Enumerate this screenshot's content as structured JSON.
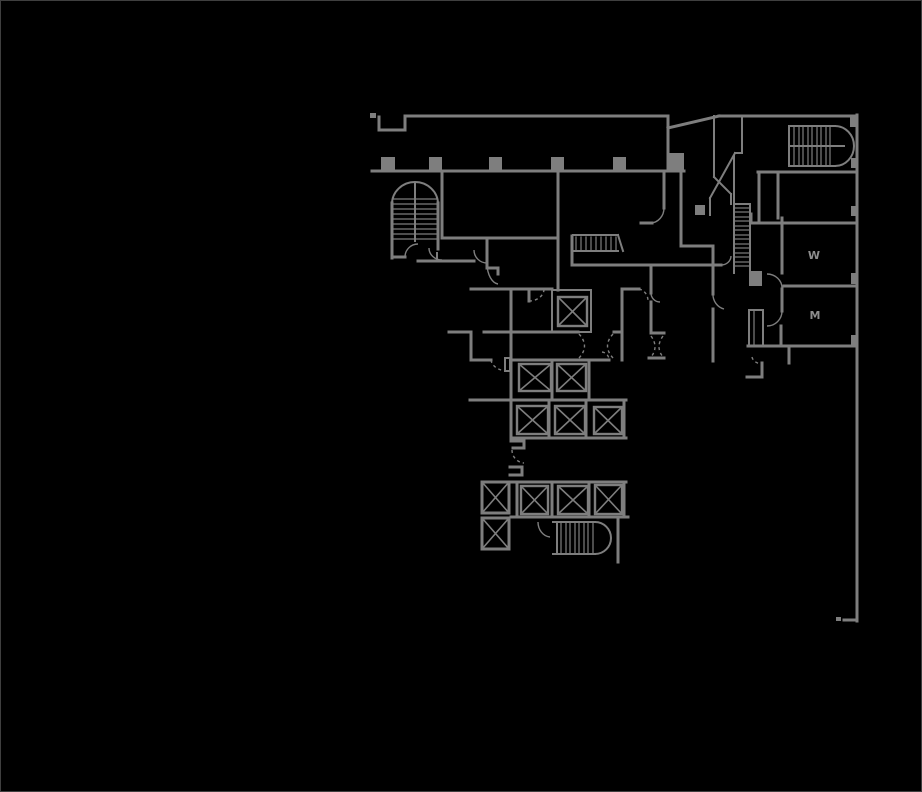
{
  "app": {
    "type": "floor-plan-viewer",
    "background": "#000000",
    "border_color": "#3f3f3f"
  },
  "plan": {
    "line_color": "#7e7e7e",
    "label_color": "#8d8d8d",
    "labels": [
      {
        "text": "W",
        "x": 813,
        "y": 258
      },
      {
        "text": "M",
        "x": 814,
        "y": 318
      }
    ],
    "walls": [
      [
        378,
        116,
        378,
        129
      ],
      [
        378,
        129,
        404,
        129
      ],
      [
        404,
        129,
        404,
        115
      ],
      [
        404,
        115,
        667,
        115
      ],
      [
        667,
        115,
        667,
        170
      ],
      [
        667,
        127,
        718,
        115
      ],
      [
        718,
        115,
        856,
        115
      ],
      [
        856,
        114,
        856,
        620
      ],
      [
        856,
        619,
        843,
        619
      ],
      [
        371,
        170,
        683,
        170
      ],
      [
        391,
        202,
        391,
        257
      ],
      [
        437,
        202,
        437,
        248
      ],
      [
        391,
        256,
        404,
        256
      ],
      [
        417,
        260,
        473,
        260
      ],
      [
        441,
        170,
        441,
        237
      ],
      [
        441,
        237,
        557,
        237
      ],
      [
        557,
        170,
        557,
        289
      ],
      [
        486,
        237,
        486,
        267
      ],
      [
        486,
        267,
        497,
        267
      ],
      [
        497,
        267,
        497,
        273
      ],
      [
        470,
        288,
        551,
        288
      ],
      [
        528,
        288,
        528,
        300
      ],
      [
        448,
        331,
        470,
        331
      ],
      [
        470,
        331,
        470,
        359
      ],
      [
        470,
        359,
        490,
        359
      ],
      [
        483,
        331,
        577,
        331
      ],
      [
        613,
        331,
        621,
        331
      ],
      [
        510,
        288,
        510,
        439
      ],
      [
        510,
        359,
        608,
        359
      ],
      [
        621,
        288,
        621,
        359
      ],
      [
        588,
        359,
        588,
        399
      ],
      [
        551,
        359,
        551,
        399
      ],
      [
        469,
        399,
        625,
        399
      ],
      [
        548,
        399,
        548,
        437
      ],
      [
        585,
        399,
        585,
        437
      ],
      [
        623,
        399,
        623,
        437
      ],
      [
        510,
        437,
        625,
        437
      ],
      [
        510,
        440,
        523,
        440
      ],
      [
        523,
        440,
        523,
        447
      ],
      [
        523,
        447,
        512,
        447
      ],
      [
        509,
        466,
        521,
        466
      ],
      [
        521,
        466,
        521,
        474
      ],
      [
        509,
        474,
        521,
        474
      ],
      [
        507,
        481,
        625,
        481
      ],
      [
        516,
        481,
        516,
        516
      ],
      [
        551,
        481,
        551,
        516
      ],
      [
        588,
        481,
        588,
        516
      ],
      [
        623,
        481,
        623,
        516
      ],
      [
        510,
        516,
        627,
        516
      ],
      [
        617,
        516,
        617,
        561
      ],
      [
        571,
        235,
        571,
        264
      ],
      [
        571,
        264,
        720,
        264
      ],
      [
        650,
        264,
        650,
        292
      ],
      [
        650,
        301,
        650,
        332
      ],
      [
        650,
        332,
        663,
        332
      ],
      [
        648,
        357,
        663,
        357
      ],
      [
        621,
        288,
        638,
        288
      ],
      [
        663,
        170,
        663,
        207
      ],
      [
        640,
        222,
        651,
        222
      ],
      [
        680,
        170,
        680,
        245
      ],
      [
        680,
        245,
        712,
        245
      ],
      [
        712,
        245,
        712,
        293
      ],
      [
        712,
        308,
        712,
        360
      ],
      [
        757,
        171,
        856,
        171
      ],
      [
        758,
        171,
        758,
        222
      ],
      [
        750,
        213,
        750,
        222
      ],
      [
        750,
        222,
        856,
        222
      ],
      [
        777,
        171,
        777,
        217
      ],
      [
        781,
        217,
        781,
        272
      ],
      [
        783,
        285,
        856,
        285
      ],
      [
        781,
        288,
        781,
        310
      ],
      [
        780,
        325,
        780,
        345
      ],
      [
        747,
        345,
        856,
        345
      ],
      [
        788,
        345,
        788,
        362
      ],
      [
        761,
        362,
        761,
        376
      ],
      [
        746,
        376,
        761,
        376
      ]
    ],
    "partitions": [
      [
        733,
        155,
        733,
        272
      ],
      [
        749,
        203,
        749,
        272
      ],
      [
        733,
        203,
        749,
        203
      ],
      [
        713,
        115,
        713,
        176
      ],
      [
        713,
        176,
        730,
        193
      ],
      [
        730,
        193,
        730,
        203
      ],
      [
        741,
        115,
        741,
        152
      ],
      [
        741,
        152,
        734,
        152
      ],
      [
        734,
        152,
        709,
        197
      ],
      [
        709,
        197,
        709,
        214
      ],
      [
        788,
        125,
        788,
        165
      ],
      [
        788,
        125,
        834,
        125
      ],
      [
        788,
        165,
        834,
        165
      ],
      [
        788,
        145,
        843,
        145
      ],
      [
        572,
        234,
        617,
        234
      ],
      [
        572,
        250,
        617,
        250
      ],
      [
        617,
        234,
        622,
        250
      ],
      [
        552,
        521,
        594,
        521
      ],
      [
        552,
        553,
        594,
        553
      ],
      [
        556,
        521,
        556,
        553
      ],
      [
        436,
        252,
        436,
        260
      ],
      [
        414,
        182,
        414,
        240
      ]
    ],
    "treads": [
      [
        392,
        198,
        436,
        198
      ],
      [
        392,
        203,
        436,
        203
      ],
      [
        392,
        208,
        436,
        208
      ],
      [
        392,
        213,
        436,
        213
      ],
      [
        392,
        218,
        436,
        218
      ],
      [
        392,
        223,
        436,
        223
      ],
      [
        392,
        228,
        436,
        228
      ],
      [
        392,
        233,
        436,
        233
      ],
      [
        392,
        238,
        436,
        238
      ],
      [
        575,
        236,
        575,
        249
      ],
      [
        580,
        236,
        580,
        249
      ],
      [
        585,
        236,
        585,
        249
      ],
      [
        590,
        236,
        590,
        249
      ],
      [
        595,
        236,
        595,
        249
      ],
      [
        600,
        236,
        600,
        249
      ],
      [
        605,
        236,
        605,
        249
      ],
      [
        610,
        236,
        610,
        249
      ],
      [
        615,
        236,
        615,
        249
      ],
      [
        734,
        207,
        748,
        207
      ],
      [
        734,
        211,
        748,
        211
      ],
      [
        734,
        216,
        748,
        216
      ],
      [
        734,
        220,
        748,
        220
      ],
      [
        734,
        225,
        748,
        225
      ],
      [
        734,
        229,
        748,
        229
      ],
      [
        734,
        234,
        748,
        234
      ],
      [
        734,
        238,
        748,
        238
      ],
      [
        734,
        243,
        748,
        243
      ],
      [
        734,
        247,
        748,
        247
      ],
      [
        734,
        252,
        748,
        252
      ],
      [
        734,
        256,
        748,
        256
      ],
      [
        734,
        261,
        748,
        261
      ],
      [
        734,
        265,
        748,
        265
      ],
      [
        793,
        126,
        793,
        164
      ],
      [
        798,
        126,
        798,
        164
      ],
      [
        802,
        126,
        802,
        164
      ],
      [
        807,
        126,
        807,
        164
      ],
      [
        811,
        126,
        811,
        164
      ],
      [
        816,
        126,
        816,
        164
      ],
      [
        820,
        126,
        820,
        164
      ],
      [
        825,
        126,
        825,
        164
      ],
      [
        829,
        126,
        829,
        164
      ],
      [
        560,
        522,
        560,
        552
      ],
      [
        565,
        522,
        565,
        552
      ],
      [
        569,
        522,
        569,
        552
      ],
      [
        574,
        522,
        574,
        552
      ],
      [
        578,
        522,
        578,
        552
      ],
      [
        583,
        522,
        583,
        552
      ],
      [
        587,
        522,
        587,
        552
      ],
      [
        592,
        522,
        592,
        552
      ],
      [
        753,
        310,
        753,
        344
      ]
    ],
    "arcs_heavy": [
      "M391,203 A23,22 0 0 1 437,203",
      "M834,125 A19,20 0 0 1 834,165",
      "M594,521 A16,16 0 0 1 594,553"
    ],
    "door_arcs": [
      "M404,256 A13,13 0 0 1 417,243",
      "M428,247 A13,12 0 0 0 441,259",
      "M473,249 A13,13 0 0 0 486,262",
      "M486,263 A12,21 0 0 0 497,283",
      "M663,207 A14,15 0 0 1 650,222",
      "M650,292 A9,9 0 0 0 659,301",
      "M712,293 A15,15 0 0 0 723,308",
      "M720,264 A10,9 0 0 0 730,255",
      "M766,273 A15,14 0 0 1 781,287",
      "M781,310 A15,15 0 0 1 766,325",
      "M537,521 A13,15 0 0 0 549,536"
    ],
    "dashed_arcs": [
      "M528,300 A15,12 0 0 0 543,288",
      "M578,333 Q589,345 578,357",
      "M612,333 Q601,345 612,357",
      "M650,335 Q658,346 650,356",
      "M662,335 Q654,346 662,356",
      "M638,288 A11,12 0 0 1 647,300",
      "M490,359 A17,12 0 0 0 506,370",
      "M511,449 A13,13 0 0 0 523,462",
      "M751,356 A11,8 0 0 0 761,363",
      "M601,351 A8,8 0 0 1 608,358"
    ],
    "filled_rects": [
      [
        369,
        112,
        6,
        5
      ],
      [
        380,
        156,
        14,
        14
      ],
      [
        428,
        156,
        13,
        14
      ],
      [
        488,
        156,
        13,
        14
      ],
      [
        550,
        156,
        13,
        14
      ],
      [
        612,
        156,
        13,
        14
      ],
      [
        667,
        152,
        16,
        18
      ],
      [
        694,
        204,
        10,
        10
      ],
      [
        748,
        270,
        13,
        15
      ],
      [
        849,
        114,
        8,
        12
      ],
      [
        850,
        157,
        7,
        10
      ],
      [
        850,
        205,
        7,
        10
      ],
      [
        850,
        272,
        7,
        11
      ],
      [
        850,
        334,
        7,
        11
      ],
      [
        835,
        616,
        5,
        4
      ]
    ],
    "outline_rects": [
      [
        551,
        289,
        39,
        42
      ],
      [
        748,
        309,
        14,
        36
      ],
      [
        504,
        357,
        5,
        13
      ]
    ],
    "elevator_shafts": [
      [
        557,
        296,
        29,
        29
      ],
      [
        518,
        363,
        32,
        27
      ],
      [
        556,
        363,
        29,
        27
      ],
      [
        516,
        405,
        31,
        28
      ],
      [
        554,
        405,
        30,
        28
      ],
      [
        593,
        406,
        28,
        27
      ],
      [
        520,
        485,
        27,
        28
      ],
      [
        557,
        485,
        30,
        28
      ],
      [
        594,
        484,
        27,
        29
      ]
    ],
    "elevator_shafts_heavy": [
      [
        481,
        481,
        27,
        31
      ],
      [
        481,
        517,
        27,
        31
      ]
    ]
  }
}
